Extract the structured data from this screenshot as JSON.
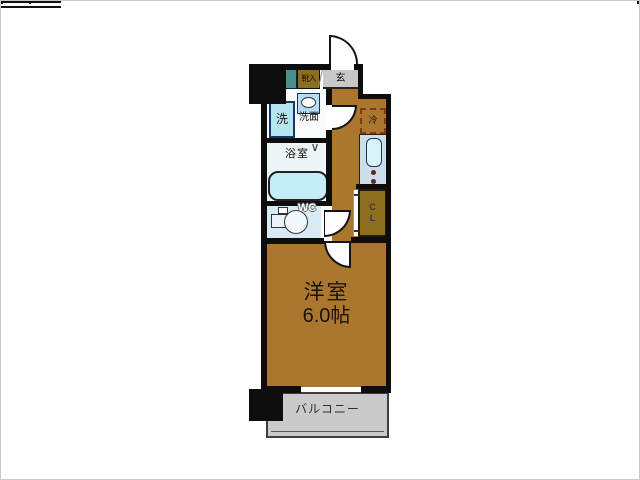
{
  "page": {
    "background": "#ffffff"
  },
  "colors": {
    "wall": "#0d0d0d",
    "floor_brown": "#ab772e",
    "storage_mustard": "#8d6e1e",
    "entry_gray": "#c8c8c8",
    "balcony_gray": "#cacaca",
    "teal_cabinet": "#47908c",
    "fixture_blue": "#b5e6f2",
    "counter_blue": "#ccdeea",
    "tub_blue": "#c4edf7",
    "wc_blue": "#d8ebf5",
    "bath_white": "#eef5f8",
    "burner_dot": "#5d2b1d",
    "fridge_dash_brown": "#7d3c10",
    "door_white": "#ffffff"
  },
  "rooms": {
    "main_room": {
      "name_label": "洋室",
      "size_label": "6.0帖"
    },
    "balcony": {
      "label": "バルコニー"
    },
    "entrance": {
      "label": "玄"
    },
    "bathroom": {
      "label": "浴室"
    },
    "washroom": {
      "label": "洗面"
    },
    "toilet": {
      "label": "WC"
    },
    "laundry_space": {
      "label": "洗"
    },
    "shoe_storage": {
      "label": "靴入"
    },
    "refrigerator_space": {
      "label": "冷"
    },
    "closet": {
      "line1": "C",
      "line2": "L"
    }
  },
  "symbols": {
    "bath_door_marker": "∨"
  }
}
